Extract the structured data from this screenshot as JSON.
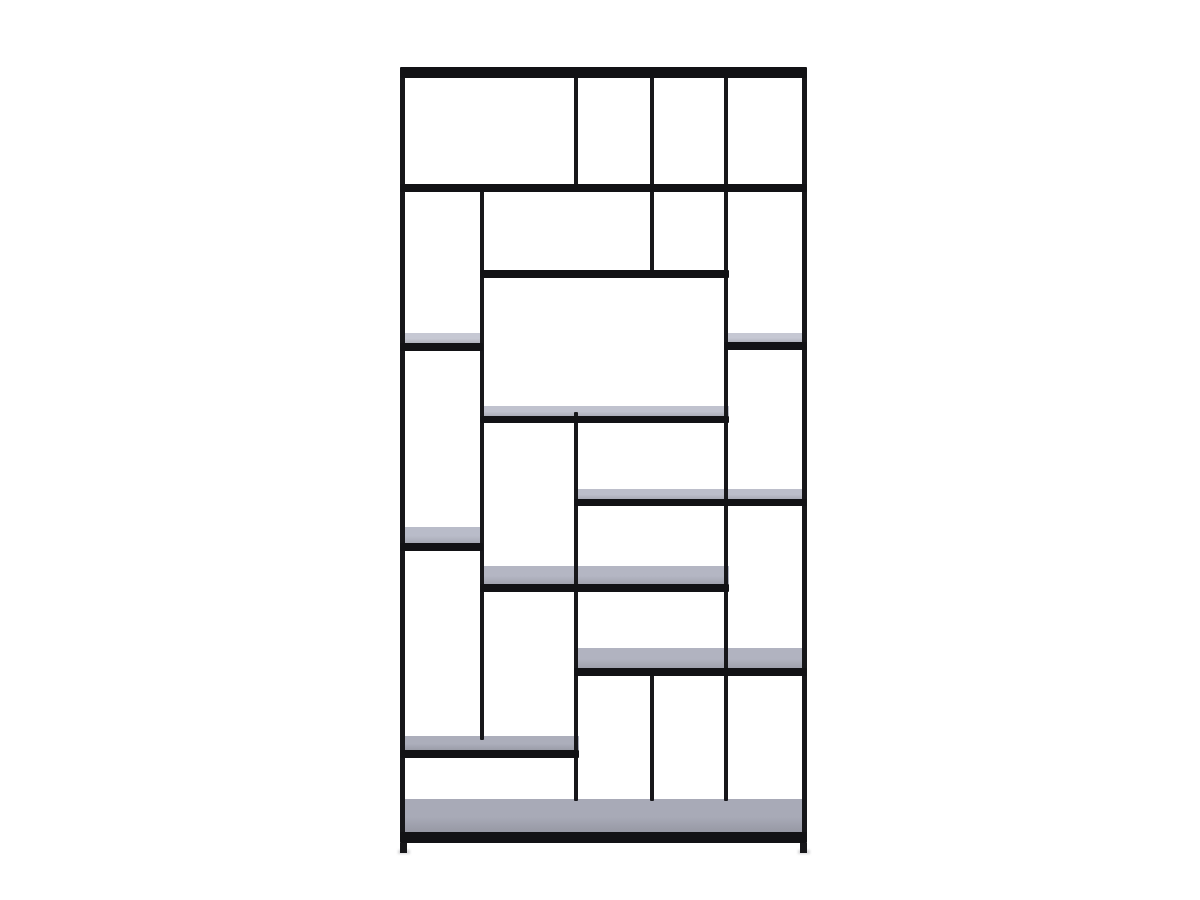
{
  "scene": {
    "description": "Product photo of a tall asymmetric black metal open shelving unit (etagere bookcase) with thin square-tube frame and staggered shelves, centered on a plain white background. Upper shelves appear solid black (viewed from below); lower shelf surfaces show light blue-gray tops (viewed from above).",
    "background_color": "#ffffff",
    "frame_color": "#17171a",
    "shelf_edge_color": "#121215",
    "foot_shadow_color": "#d8d8da"
  },
  "unit": {
    "bounds": {
      "x": 400,
      "y": 67,
      "width": 407,
      "height": 786
    },
    "posts": [
      {
        "name": "left-frame-post",
        "x": 400,
        "y": 68,
        "w": 5,
        "h": 775
      },
      {
        "name": "right-frame-post",
        "x": 802,
        "y": 68,
        "w": 5,
        "h": 775
      },
      {
        "name": "top-row-divider-post",
        "x": 574,
        "y": 76,
        "w": 4,
        "h": 110
      },
      {
        "name": "upper-mid-divider-post",
        "x": 650,
        "y": 76,
        "w": 4,
        "h": 198
      },
      {
        "name": "lower-mid-divider-post",
        "x": 650,
        "y": 672,
        "w": 4,
        "h": 129
      },
      {
        "name": "right-inner-post",
        "x": 724,
        "y": 76,
        "w": 4,
        "h": 725
      },
      {
        "name": "left-inner-post",
        "x": 480,
        "y": 188,
        "w": 4,
        "h": 552
      },
      {
        "name": "center-lower-post",
        "x": 574,
        "y": 412,
        "w": 4,
        "h": 389
      }
    ],
    "shelves": [
      {
        "name": "top-shelf",
        "x": 400,
        "y": 67,
        "w": 407,
        "top_h": 0,
        "edge_h": 11,
        "top_color": null
      },
      {
        "name": "second-shelf",
        "x": 400,
        "y": 184,
        "w": 407,
        "top_h": 0,
        "edge_h": 8,
        "top_color": null
      },
      {
        "name": "third-shelf",
        "x": 480,
        "y": 270,
        "w": 249,
        "top_h": 0,
        "edge_h": 8,
        "top_color": null
      },
      {
        "name": "left-small-shelf-upper",
        "x": 400,
        "y": 333,
        "w": 83,
        "top_h": 10,
        "edge_h": 8,
        "top_color": "#c6c8d3"
      },
      {
        "name": "right-small-shelf",
        "x": 724,
        "y": 333,
        "w": 83,
        "top_h": 9,
        "edge_h": 8,
        "top_color": "#c6c8d3"
      },
      {
        "name": "center-wide-shelf",
        "x": 480,
        "y": 406,
        "w": 249,
        "top_h": 10,
        "edge_h": 7,
        "top_color": "#c0c2ce"
      },
      {
        "name": "right-wide-shelf-upper",
        "x": 574,
        "y": 489,
        "w": 233,
        "top_h": 10,
        "edge_h": 7,
        "top_color": "#bcbeca"
      },
      {
        "name": "left-small-shelf-lower",
        "x": 400,
        "y": 527,
        "w": 83,
        "top_h": 16,
        "edge_h": 8,
        "top_color": "#b9bcc9"
      },
      {
        "name": "center-wide-shelf-lower",
        "x": 480,
        "y": 566,
        "w": 249,
        "top_h": 18,
        "edge_h": 8,
        "top_color": "#b4b6c3"
      },
      {
        "name": "right-wide-shelf-lower",
        "x": 574,
        "y": 648,
        "w": 233,
        "top_h": 20,
        "edge_h": 8,
        "top_color": "#b1b3c0"
      },
      {
        "name": "left-wide-shelf-bottom",
        "x": 400,
        "y": 736,
        "w": 179,
        "top_h": 14,
        "edge_h": 8,
        "top_color": "#acaebb"
      },
      {
        "name": "bottom-shelf",
        "x": 400,
        "y": 799,
        "w": 407,
        "top_h": 33,
        "edge_h": 11,
        "top_color": "#a8aab7"
      }
    ],
    "feet": [
      {
        "name": "left-foot",
        "x": 400,
        "y": 843,
        "w": 7,
        "h": 10
      },
      {
        "name": "right-foot",
        "x": 800,
        "y": 843,
        "w": 7,
        "h": 10
      }
    ]
  }
}
